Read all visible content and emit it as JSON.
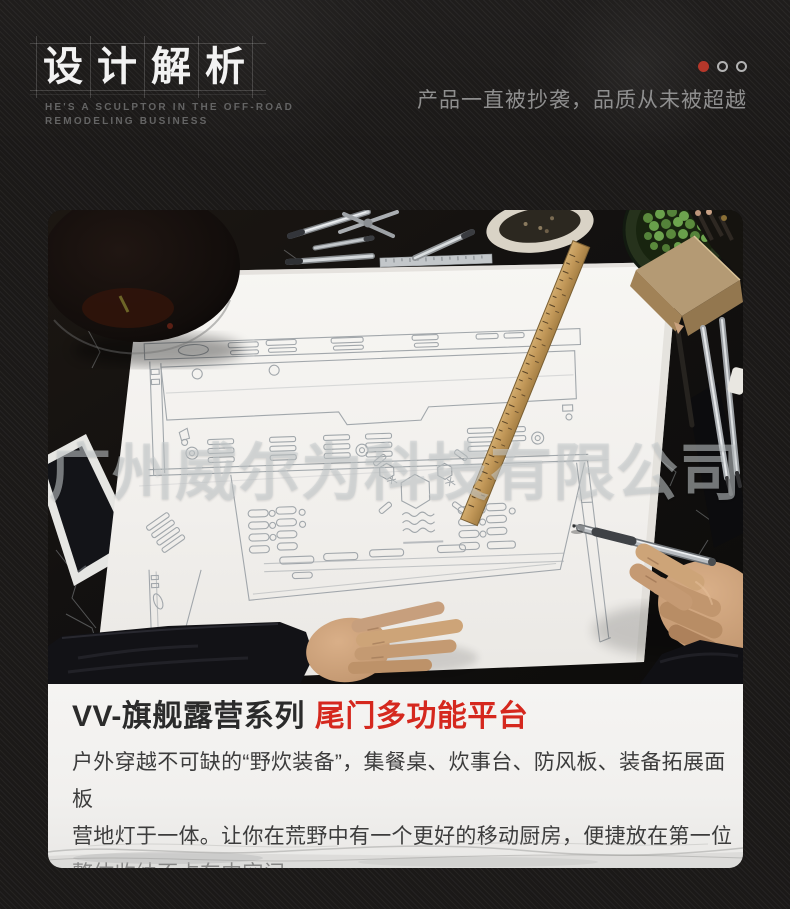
{
  "header": {
    "title_chars": [
      "设",
      "计",
      "解",
      "析"
    ],
    "subtitle_line1": "HE'S A SCULPTOR IN THE OFF-ROAD",
    "subtitle_line2": "REMODELING BUSINESS",
    "slogan": "产品一直被抄袭，品质从未被超越",
    "carousel": {
      "dot_count": 3,
      "active_index": 0
    }
  },
  "photo": {
    "watermark": "广州威尔为科技有限公司"
  },
  "product": {
    "series_title": "VV-旗舰露营系列",
    "highlight_title": "尾门多功能平台",
    "description_lines": [
      "户外穿越不可缺的“野炊装备”，集餐桌、炊事台、防风板、装备拓展面板",
      "营地灯于一体。让你在荒野中有一个更好的移动厨房，便捷放在第一位",
      "整体收纳不占车内空间"
    ]
  },
  "colors": {
    "accent_red": "#d5281e",
    "carousel_dot_red": "#b5372a",
    "page_background": "#1b1918",
    "panel_background": "#f1f0ee"
  }
}
